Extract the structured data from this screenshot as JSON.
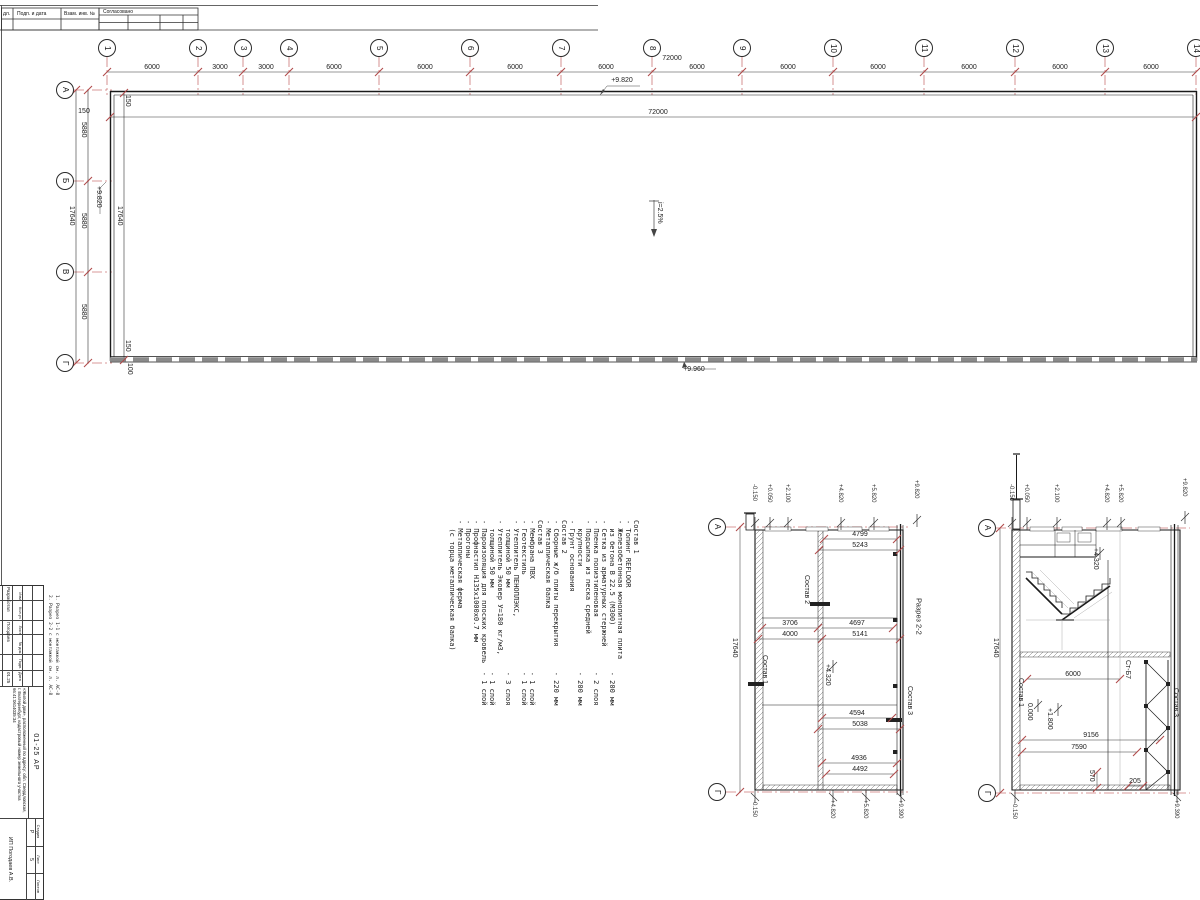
{
  "colors": {
    "axis_red": "#cc7777",
    "tick_red": "#b04a4a",
    "line_black": "#222222",
    "hatch_gray": "#777777"
  },
  "frame": {
    "corner_cell": "дл.",
    "cells": [
      "Подп. и дата",
      "Взам. инв. №"
    ],
    "approved": "Согласовано"
  },
  "plan": {
    "columns": [
      {
        "t": "1",
        "x": 107,
        "y": 48
      },
      {
        "t": "2",
        "x": 198,
        "y": 48
      },
      {
        "t": "3",
        "x": 243,
        "y": 48
      },
      {
        "t": "4",
        "x": 289,
        "y": 48
      },
      {
        "t": "5",
        "x": 379,
        "y": 48
      },
      {
        "t": "6",
        "x": 470,
        "y": 48
      },
      {
        "t": "7",
        "x": 561,
        "y": 48
      },
      {
        "t": "8",
        "x": 652,
        "y": 48
      },
      {
        "t": "9",
        "x": 742,
        "y": 48
      },
      {
        "t": "10",
        "x": 833,
        "y": 48
      },
      {
        "t": "11",
        "x": 924,
        "y": 48
      },
      {
        "t": "12",
        "x": 1015,
        "y": 48
      },
      {
        "t": "13",
        "x": 1105,
        "y": 48
      },
      {
        "t": "14",
        "x": 1196,
        "y": 48
      }
    ],
    "rows": [
      {
        "t": "А",
        "x": 65,
        "y": 90
      },
      {
        "t": "Б",
        "x": 65,
        "y": 181
      },
      {
        "t": "В",
        "x": 65,
        "y": 272
      },
      {
        "t": "Г",
        "x": 65,
        "y": 363
      }
    ],
    "col_dims": [
      {
        "t": "6000",
        "x": 152,
        "y": 64
      },
      {
        "t": "3000",
        "x": 220,
        "y": 64
      },
      {
        "t": "3000",
        "x": 266,
        "y": 64
      },
      {
        "t": "6000",
        "x": 334,
        "y": 64
      },
      {
        "t": "6000",
        "x": 425,
        "y": 64
      },
      {
        "t": "6000",
        "x": 515,
        "y": 64
      },
      {
        "t": "6000",
        "x": 606,
        "y": 64
      },
      {
        "t": "6000",
        "x": 697,
        "y": 64
      },
      {
        "t": "6000",
        "x": 788,
        "y": 64
      },
      {
        "t": "6000",
        "x": 878,
        "y": 64
      },
      {
        "t": "6000",
        "x": 969,
        "y": 64
      },
      {
        "t": "6000",
        "x": 1060,
        "y": 64
      },
      {
        "t": "6000",
        "x": 1151,
        "y": 64
      }
    ],
    "h_texts": [
      {
        "t": "72000",
        "x": 672,
        "y": 55
      },
      {
        "t": "72000",
        "x": 658,
        "y": 109
      },
      {
        "t": "+9.820",
        "x": 622,
        "y": 77
      },
      {
        "t": "+9.960",
        "x": 694,
        "y": 366
      },
      {
        "t": "150",
        "x": 84,
        "y": 108
      }
    ],
    "v_texts": [
      {
        "t": "5880",
        "x": 80,
        "y": 122
      },
      {
        "t": "5880",
        "x": 80,
        "y": 213
      },
      {
        "t": "5880",
        "x": 80,
        "y": 304
      },
      {
        "t": "17640",
        "x": 68,
        "y": 206
      },
      {
        "t": "17640",
        "x": 116,
        "y": 206
      },
      {
        "t": "+9.820",
        "x": 95,
        "y": 186
      },
      {
        "t": "i=2.5%",
        "x": 656,
        "y": 202
      },
      {
        "t": "150",
        "x": 124,
        "y": 95
      },
      {
        "t": "150",
        "x": 124,
        "y": 340
      },
      {
        "t": "100",
        "x": 126,
        "y": 363
      }
    ]
  },
  "notes": {
    "lines": [
      "Состав 1",
      "- Топинг REFLOOR",
      "- Железобетонная монолитная плита",
      "  из бетона В 22.5 (М300)           - 200 мм",
      "- Сетка из арматурных стержней",
      "- Пленка полиэтиленовая             - 2 слоя",
      "- Подсыпка из песка средней",
      "  крупности                         - 200 мм",
      "- Грунт основания",
      "",
      "Состав 2",
      "- Сборные ж/б плиты перекрытия      - 220 мм",
      "- Металлическая балка",
      "",
      "Состав 3",
      "- Мембрана ПВХ                      - 1 слой",
      "- Геотекстиль                       - 1 слой",
      "- Утеплитель ПЕНОПЛЭКС,",
      "  толщиной 50 мм                    - 3 слоя",
      "- Утеплитель Эковер У=180 кг/м3,",
      "  толщиной 50 мм                    - 1 слой",
      "- Пароизоляция для плоских кровель  - 1 слой",
      "- Профнастил Н135х1000х0.7 мм",
      "- Прогоны",
      "- Металлическая ферма",
      "  (с торца металлическая балка)"
    ]
  },
  "section22": {
    "title": "Разрез 2-2",
    "bubbles": [
      {
        "t": "А",
        "x": 717,
        "y": 527
      },
      {
        "t": "Г",
        "x": 717,
        "y": 792
      }
    ],
    "h_dims": [
      {
        "t": "4799",
        "x": 860,
        "y": 531
      },
      {
        "t": "5243",
        "x": 860,
        "y": 542
      },
      {
        "t": "3706",
        "x": 790,
        "y": 620
      },
      {
        "t": "4000",
        "x": 790,
        "y": 631
      },
      {
        "t": "4697",
        "x": 857,
        "y": 620
      },
      {
        "t": "5141",
        "x": 860,
        "y": 631
      },
      {
        "t": "4594",
        "x": 857,
        "y": 710
      },
      {
        "t": "5038",
        "x": 860,
        "y": 721
      },
      {
        "t": "4936",
        "x": 859,
        "y": 755
      },
      {
        "t": "4492",
        "x": 860,
        "y": 766
      }
    ],
    "flags_top": [
      {
        "t": "-0.150",
        "x": 751,
        "y": 484
      },
      {
        "t": "+0.050",
        "x": 766,
        "y": 484
      },
      {
        "t": "+2.100",
        "x": 784,
        "y": 484
      },
      {
        "t": "+4.820",
        "x": 837,
        "y": 484
      },
      {
        "t": "+5.820",
        "x": 870,
        "y": 484
      },
      {
        "t": "+9.820",
        "x": 913,
        "y": 480
      }
    ],
    "flags_bottom": [
      {
        "t": "-0.150",
        "x": 751,
        "y": 800
      },
      {
        "t": "+4.820",
        "x": 829,
        "y": 800
      },
      {
        "t": "+5.820",
        "x": 862,
        "y": 800
      },
      {
        "t": "+9.390",
        "x": 897,
        "y": 800
      }
    ],
    "v_texts": [
      {
        "t": "17640",
        "x": 731,
        "y": 638
      },
      {
        "t": "+4.320",
        "x": 824,
        "y": 664
      },
      {
        "t": "Состав 2",
        "x": 803,
        "y": 575
      },
      {
        "t": "Состав 1",
        "x": 761,
        "y": 655
      },
      {
        "t": "Состав 3",
        "x": 906,
        "y": 686
      }
    ]
  },
  "section11": {
    "bubbles": [
      {
        "t": "А",
        "x": 987,
        "y": 528
      },
      {
        "t": "Г",
        "x": 987,
        "y": 793
      }
    ],
    "h_dims": [
      {
        "t": "6000",
        "x": 1073,
        "y": 671
      },
      {
        "t": "9156",
        "x": 1091,
        "y": 732
      },
      {
        "t": "7590",
        "x": 1079,
        "y": 744
      },
      {
        "t": "205",
        "x": 1135,
        "y": 778
      }
    ],
    "flags_top": [
      {
        "t": "-0.150",
        "x": 1008,
        "y": 484
      },
      {
        "t": "+0.050",
        "x": 1023,
        "y": 484
      },
      {
        "t": "+2.100",
        "x": 1053,
        "y": 484
      },
      {
        "t": "+4.820",
        "x": 1103,
        "y": 484
      },
      {
        "t": "+5.820",
        "x": 1117,
        "y": 484
      },
      {
        "t": "+9.820",
        "x": 1181,
        "y": 478
      }
    ],
    "flags_bottom": [
      {
        "t": "-0.150",
        "x": 1011,
        "y": 802
      },
      {
        "t": "+9.390",
        "x": 1173,
        "y": 800
      }
    ],
    "v_texts": [
      {
        "t": "17640",
        "x": 992,
        "y": 638
      },
      {
        "t": "0.000",
        "x": 1026,
        "y": 703
      },
      {
        "t": "+1.800",
        "x": 1046,
        "y": 708
      },
      {
        "t": "+4.320",
        "x": 1092,
        "y": 548
      },
      {
        "t": "570",
        "x": 1088,
        "y": 770
      },
      {
        "t": "Ст-Б7",
        "x": 1124,
        "y": 660
      },
      {
        "t": "Состав 1",
        "x": 1017,
        "y": 678
      },
      {
        "t": "Состав 3",
        "x": 1172,
        "y": 688
      }
    ]
  },
  "side_notes": {
    "lines": [
      "1. Разрез 1-1 с монтажкой см. л. АС-8",
      "2. Разрез 2-2 с монтажкой см. л. АС-8"
    ]
  },
  "titleblock": {
    "header_cols": [
      "Изм",
      "Кол.уч",
      "Лист",
      "№ док.",
      "Подп.",
      "Дата"
    ],
    "row1_label": "Разработал",
    "row1_name": "Погодаев",
    "row1_date": "01.25",
    "doc_code": "01-25 АР",
    "description": "«Жилой дом», расположенный по адресу: обл. Свердловская, г. Екатеринбург, кадастровый номер земельного участка 66:41:0614035:34",
    "stage_label": "Стадия",
    "sheet_label": "Лист",
    "sheets_label": "Листов",
    "stage": "Р",
    "sheet": "5",
    "sheets": "",
    "org": "ИП Погодаев А.В."
  }
}
